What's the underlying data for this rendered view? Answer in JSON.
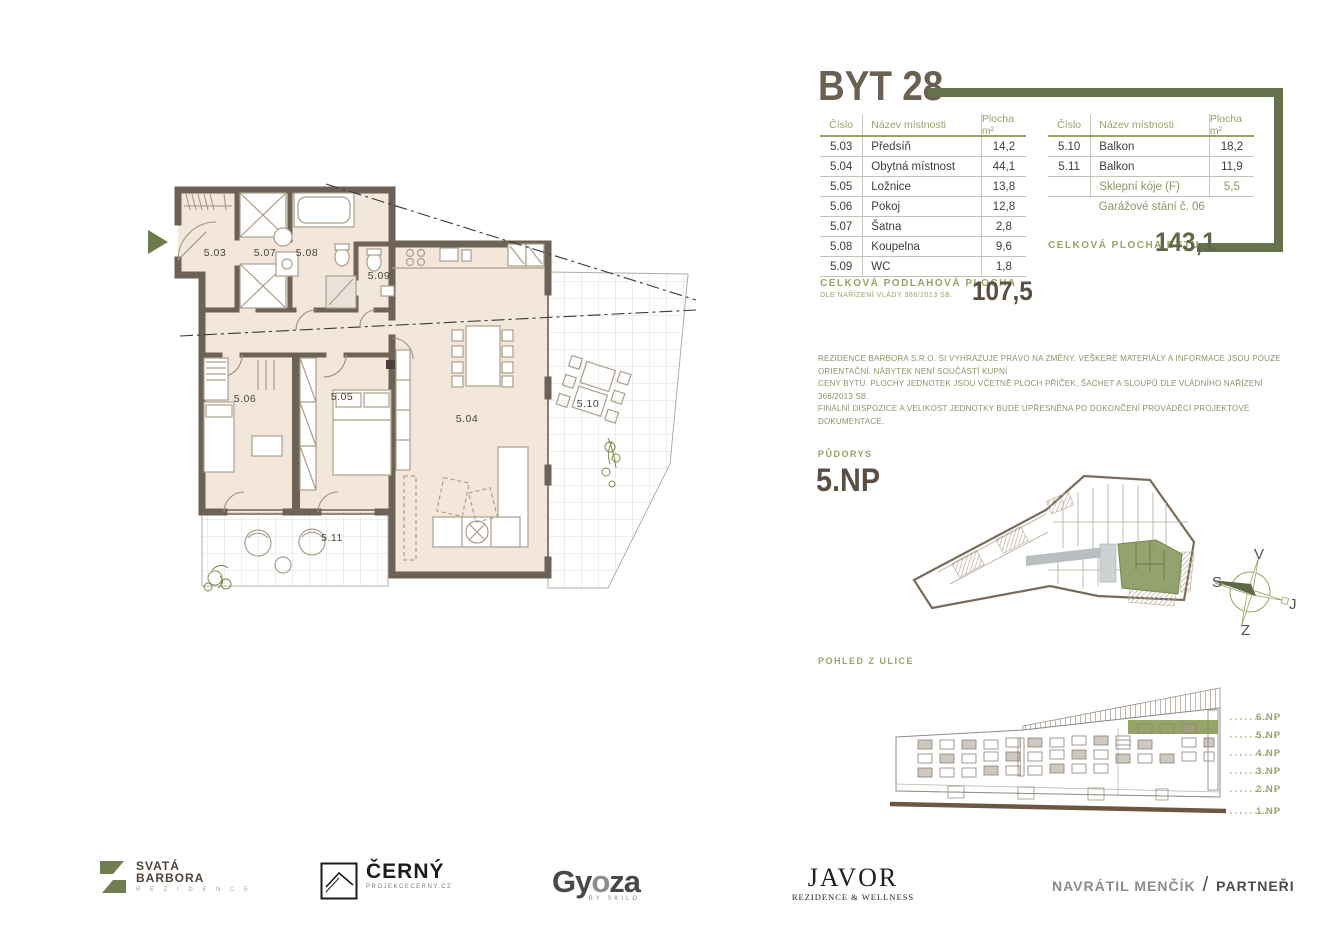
{
  "header": {
    "title": "BYT 28"
  },
  "left_table": {
    "headers": [
      "Číslo",
      "Název místnosti",
      "Plocha m²"
    ],
    "rows": [
      {
        "c": "5.03",
        "n": "Předsíň",
        "p": "14,2"
      },
      {
        "c": "5.04",
        "n": "Obytná místnost",
        "p": "44,1"
      },
      {
        "c": "5.05",
        "n": "Ložnice",
        "p": "13,8"
      },
      {
        "c": "5.06",
        "n": "Pokoj",
        "p": "12,8"
      },
      {
        "c": "5.07",
        "n": "Šatna",
        "p": "2,8"
      },
      {
        "c": "5.08",
        "n": "Koupelna",
        "p": "9,6"
      },
      {
        "c": "5.09",
        "n": "WC",
        "p": "1,8"
      }
    ]
  },
  "right_table": {
    "headers": [
      "Číslo",
      "Název místnosti",
      "Plocha m²"
    ],
    "rows": [
      {
        "c": "5.10",
        "n": "Balkon",
        "p": "18,2"
      },
      {
        "c": "5.11",
        "n": "Balkon",
        "p": "11,9"
      },
      {
        "c": "",
        "n": "Sklepní kóje (F)",
        "p": "5,5"
      },
      {
        "c": "",
        "n": "Garážové stání č. 06",
        "p": ""
      }
    ]
  },
  "totals": {
    "floor_area_label": "CELKOVÁ PODLAHOVÁ PLOCHA",
    "floor_area_sub": "DLE NAŘÍZENÍ VLÁDY 366/2013 SB.",
    "floor_area_value": "107,5",
    "unit_area_label": "CELKOVÁ PLOCHA BYTU",
    "unit_area_value": "143,1"
  },
  "disclaimer": {
    "line1": "REZIDENCE BARBORA S.R.O. SI VYHRAZUJE PRÁVO NA ZMĚNY. VEŠKERÉ MATERIÁLY A INFORMACE JSOU POUZE ORIENTAČNÍ. NÁBYTEK NENÍ SOUČÁSTÍ KUPNÍ",
    "line2": "CENY BYTU. PLOCHY JEDNOTEK JSOU VČETNĚ PLOCH PŘÍČEK, ŠACHET A SLOUPŮ DLE VLÁDNÍHO NAŘÍZENÍ 366/2013 SB.",
    "line3": "FINÁLNÍ DISPOZICE A VELIKOST JEDNOTKY BUDE UPŘESNĚNA PO DOKONČENÍ PROVÁDĚCÍ PROJEKTOVÉ DOKUMENTACE."
  },
  "pudorys": {
    "label": "PŮDORYS",
    "floor": "5.NP"
  },
  "elevation": {
    "label": "POHLED Z ULICE",
    "floors": [
      "6.NP",
      "5.NP",
      "4.NP",
      "3.NP",
      "2.NP",
      "1.NP"
    ]
  },
  "compass": {
    "top": "V",
    "left": "S",
    "right": "J",
    "bottom": "Z"
  },
  "floorplan": {
    "rooms": [
      "5.03",
      "5.07",
      "5.08",
      "5.09",
      "5.06",
      "5.05",
      "5.04",
      "5.10",
      "5.11"
    ]
  },
  "footer": {
    "logo1_line1": "SVATÁ",
    "logo1_line2": "BARBORA",
    "logo1_sub": "R E Z I D E N C E",
    "logo2": "ČERNÝ",
    "logo2_sub": "PROJEKCECERNY.CZ",
    "logo3_a": "Gy",
    "logo3_b": "o",
    "logo3_c": "za",
    "logo3_sub": "BY SKILO",
    "logo4": "JAVOR",
    "logo4_sub": "REZIDENCE & WELLNESS",
    "logo5_name": "NAVRÁTIL MENČÍK",
    "logo5_sep": "/",
    "logo5_partner": "PARTNEŘI"
  },
  "colors": {
    "accent_olive_dark": "#66724c",
    "accent_olive_light": "#9aa266",
    "wall_brown": "#6e6156",
    "room_beige": "#f2e7da",
    "title_brown": "#6b6054",
    "highlight_unit_green": "#8a9a63"
  }
}
